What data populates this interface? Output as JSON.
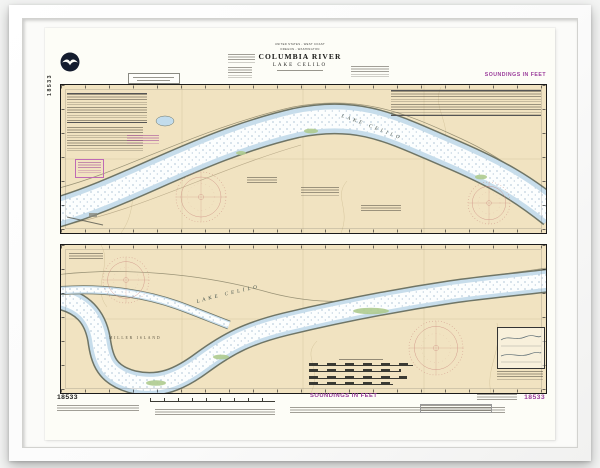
{
  "chart": {
    "icons": {
      "noaa_logo": "noaa-circle-gull-emblem"
    },
    "title_block": {
      "line1": "UNITED STATES - WEST COAST",
      "line2": "OREGON - WASHINGTON",
      "title": "COLUMBIA RIVER",
      "subtitle": "LAKE CELILO"
    },
    "margin_labels": {
      "soundings_top": "SOUNDINGS IN FEET",
      "soundings_bottom": "SOUNDINGS IN FEET",
      "number_side": "18533",
      "number_bottom_left": "18533",
      "number_bottom_right": "18533"
    },
    "place_labels": {
      "upper_river": "LAKE CELILO",
      "lower_river": "LAKE CELILO",
      "island": "MILLER ISLAND"
    },
    "colors": {
      "land": "#f1e3c1",
      "shallow_water": "#c7ddeb",
      "channel_water": "#fcfefe",
      "sounding_dots": "#4e7ca3",
      "magenta_accent": "#9b3d9b",
      "compass_rose": "#c9877e",
      "neatline": "#1a1a1a",
      "paper": "#fdfdf7"
    }
  }
}
